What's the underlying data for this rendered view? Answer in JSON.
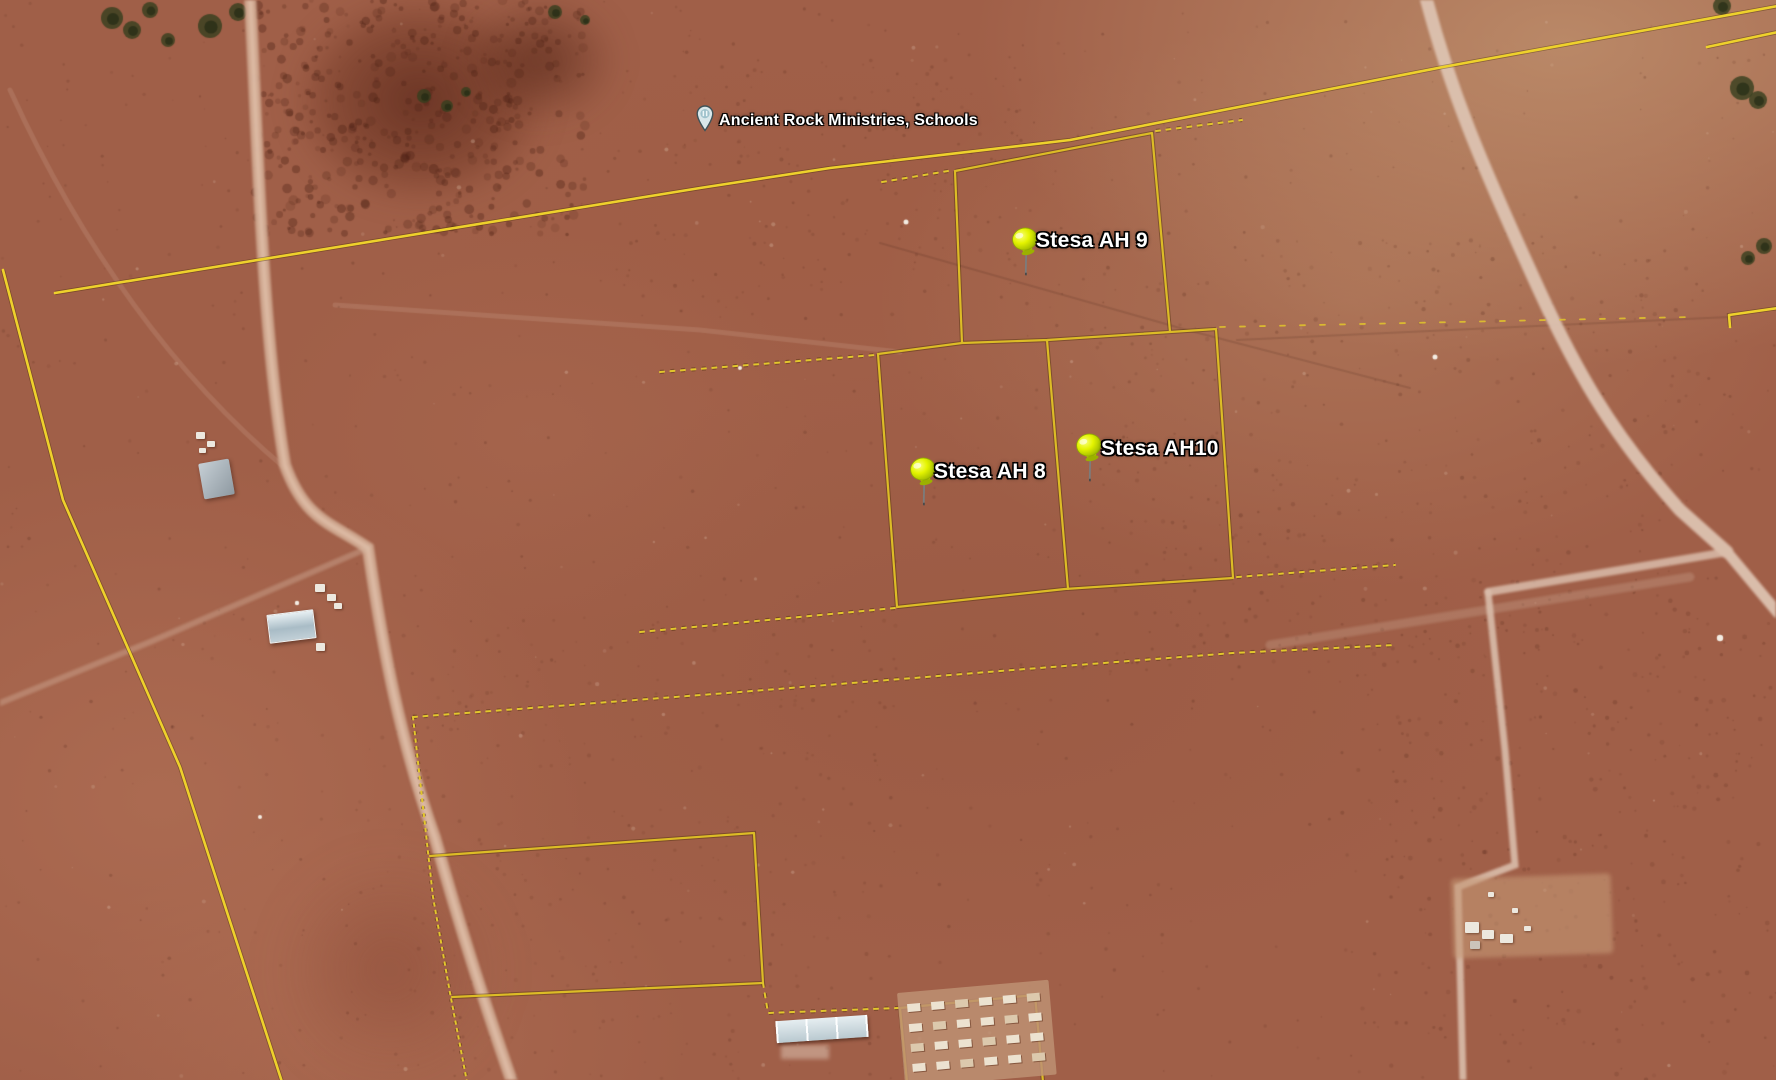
{
  "app": {
    "title": "Satellite map view with property parcels"
  },
  "map": {
    "place_marker": {
      "label": "Ancient Rock Ministries, Schools",
      "icon": "place-balloon-icon",
      "x": 696,
      "y": 104
    },
    "pins": [
      {
        "id": "stesa-ah-9",
        "label": "Stesa AH 9",
        "icon": "pushpin-icon",
        "pin_x": 1008,
        "pin_y": 226,
        "label_x": 1036,
        "label_y": 230
      },
      {
        "id": "stesa-ah-8",
        "label": "Stesa AH 8",
        "icon": "pushpin-icon",
        "pin_x": 906,
        "pin_y": 456,
        "label_x": 934,
        "label_y": 461
      },
      {
        "id": "stesa-ah-10",
        "label": "Stesa AH10",
        "icon": "pushpin-icon",
        "pin_x": 1072,
        "pin_y": 432,
        "label_x": 1101,
        "label_y": 438
      }
    ],
    "compound_grid": {
      "rows": 4,
      "cols": 6
    },
    "colors": {
      "line_bright": "#eed12c",
      "line_parcel": "#dcbc26",
      "line_dash": "#e2c62c",
      "pin_yellow": "#dff000",
      "label_text": "#ffffff",
      "terrain_base": "#a05f48",
      "road_tan": "#cfa890",
      "road_white": "#ddc2b0"
    }
  }
}
